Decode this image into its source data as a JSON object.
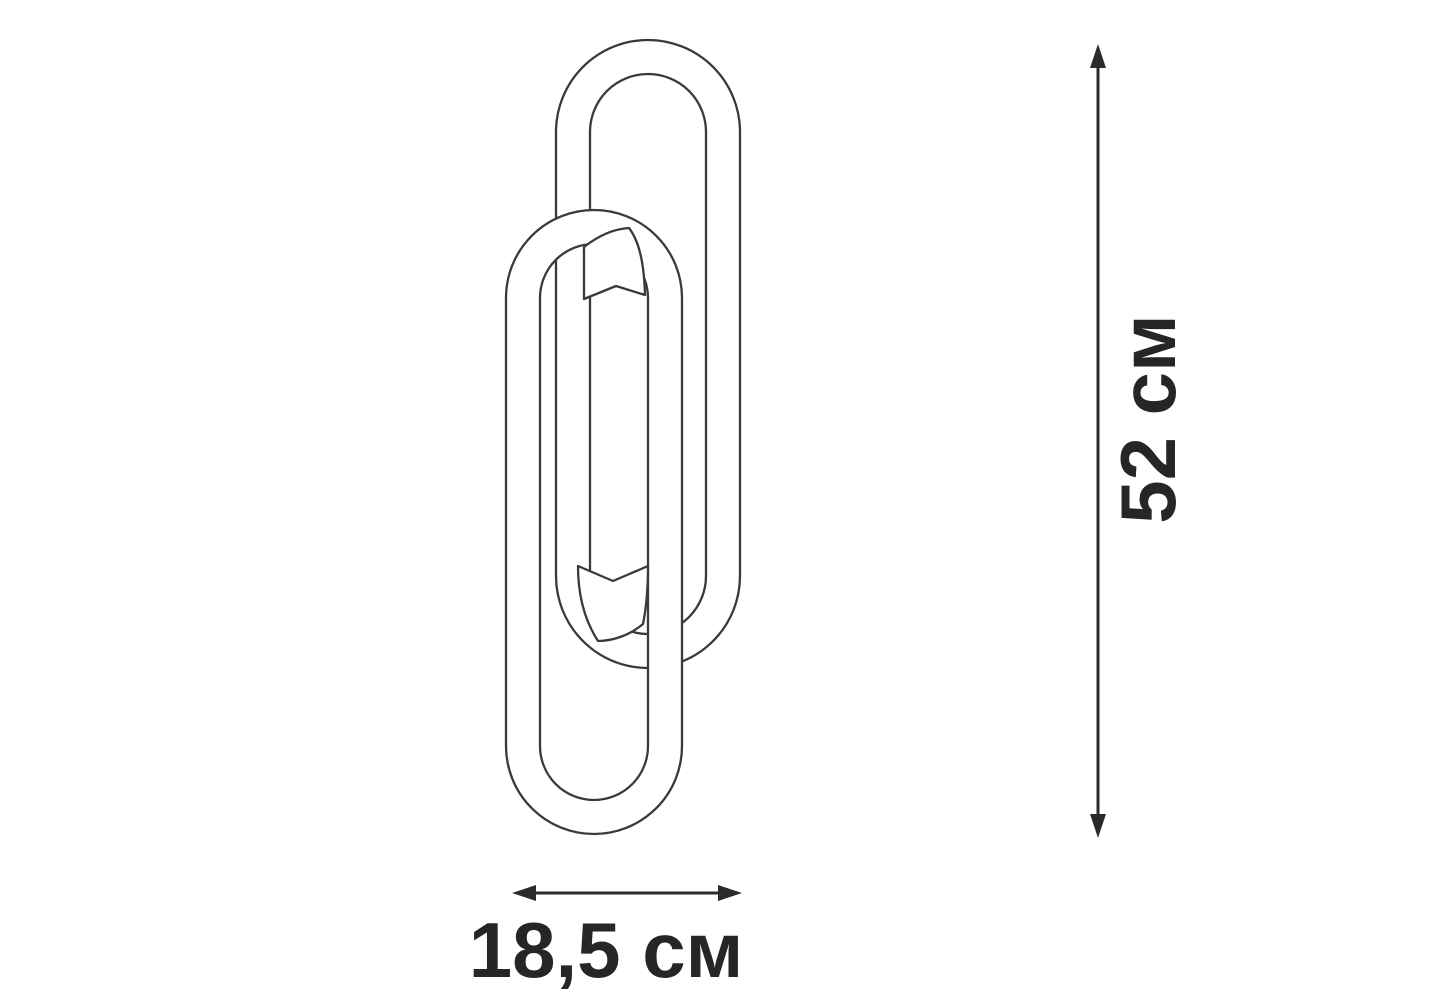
{
  "page": {
    "background": "#ffffff"
  },
  "drawing": {
    "name": "two-interlocked-oval-rings-sconce-line-drawing",
    "line_color": "#3a3a3a",
    "fill_color": "#ffffff"
  },
  "dimensions": {
    "arrow_color": "#2b2b2b",
    "text_color": "#262626",
    "height_label": "52 см",
    "width_label": "18,5 см"
  }
}
